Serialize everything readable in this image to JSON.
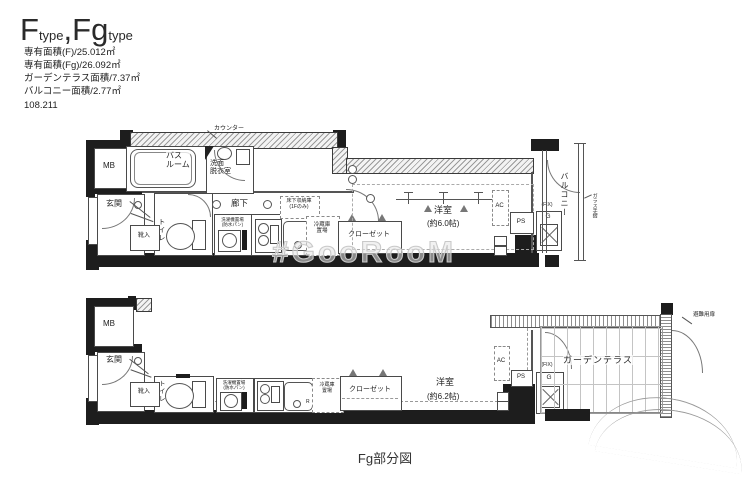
{
  "header": {
    "title": {
      "f": "F",
      "type1": "type",
      "sep": ",",
      "fg": "Fg",
      "type2": "type"
    },
    "lines": [
      "専有面積(F)/25.012㎡",
      "専有面積(Fg)/26.092㎡",
      "ガーデンテラス面積/7.37㎡",
      "バルコニー面積/2.77㎡"
    ],
    "code": "108.211"
  },
  "watermark": "#GooRooM",
  "caption": "Fg部分図",
  "colors": {
    "wall": "#1d1d1d",
    "accent_line": "#4a4a4a"
  },
  "plan_f": {
    "mb": "MB",
    "genkan": "玄関",
    "shoe": "靴入",
    "bath_l1": "バス",
    "bath_l2": "ルーム",
    "wash_l1": "洗面",
    "wash_l2": "脱衣室",
    "counter": "カウンター",
    "toilet": "トイレ",
    "hall": "廊下",
    "laundry_l1": "洗濯機置場",
    "laundry_l2": "(防水パン)",
    "underfloor_l1": "床下収納庫",
    "underfloor_l2": "(1Fのみ)",
    "fridge_l1": "冷蔵庫",
    "fridge_l2": "置場",
    "closet": "クローゼット",
    "room": "洋室",
    "room_size": "(約6.0帖)",
    "ac": "AC",
    "ps": "PS",
    "g": "G",
    "fix": "(FIX)",
    "balcony": "バルコニー",
    "rail": "ガラス手摺"
  },
  "plan_fg": {
    "mb": "MB",
    "genkan": "玄関",
    "shoe": "靴入",
    "toilet": "トイレ",
    "laundry_l1": "洗濯機置場",
    "laundry_l2": "(防水パン)",
    "fridge_l1": "冷蔵庫",
    "fridge_l2": "置場",
    "r": "R",
    "closet": "クローゼット",
    "room": "洋室",
    "room_size": "(約6.2帖)",
    "ac": "AC",
    "ps": "PS",
    "g": "G",
    "fix": "(FIX)",
    "terrace": "ガーデンテラス",
    "hatch_door": "避難用扉"
  }
}
